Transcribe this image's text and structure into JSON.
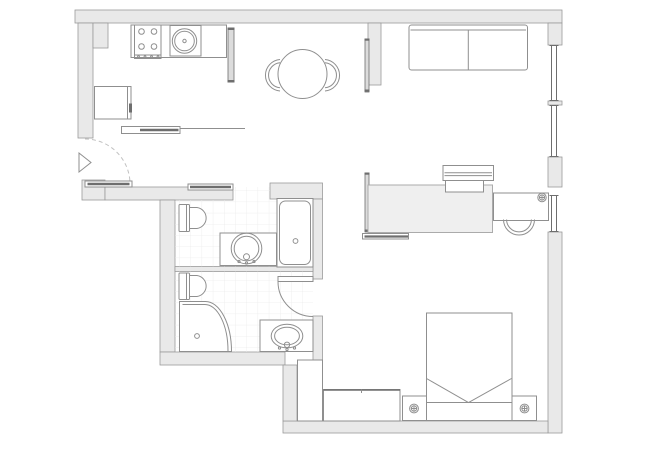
{
  "meta": {
    "kind": "floor-plan",
    "description": "apartment floor plan drawing, no text labels"
  },
  "colors": {
    "paper": "#ffffff",
    "wall_fill": "#e9e9e9",
    "wall_stroke": "#9a9a9a",
    "furniture_stroke": "#8f8f8f",
    "dark_detail": "#6e6e6e",
    "panel_fill": "#dcdcdc",
    "tile_line": "#ececec",
    "daybed_fill": "#efefef",
    "dash_line": "#c2c2c2"
  },
  "legend": {
    "windows_on_right_wall": 3,
    "rooms": [
      {
        "name": "entry",
        "items": [
          "entrance-triangle-marker",
          "entry-door-swing",
          "entry-door-leaf"
        ]
      },
      {
        "name": "kitchen",
        "items": [
          "counter",
          "cooktop-4-burner",
          "round-sink",
          "refrigerator",
          "console-shelf",
          "sliding-panel"
        ]
      },
      {
        "name": "dining-area",
        "items": [
          "round-table",
          "chair-left",
          "chair-right"
        ]
      },
      {
        "name": "living-area",
        "items": [
          "two-seat-sofa",
          "partition-wall"
        ]
      },
      {
        "name": "study-sleep-area",
        "items": [
          "daybed",
          "bench",
          "low-console",
          "desk",
          "desk-lamp",
          "office-chair",
          "sliding-panel-upper",
          "sliding-panel-lower"
        ]
      },
      {
        "name": "bathroom-1",
        "items": [
          "sliding-door",
          "toilet",
          "vanity-round-sink",
          "bathtub",
          "tiled-floor"
        ]
      },
      {
        "name": "bathroom-2",
        "items": [
          "hinged-door",
          "toilet",
          "corner-shower",
          "vanity-oval-sink",
          "tiled-floor"
        ]
      },
      {
        "name": "bedroom",
        "items": [
          "double-bed",
          "nightstand-left",
          "nightstand-right",
          "table-lamp-left",
          "table-lamp-right",
          "dresser",
          "closet"
        ]
      }
    ]
  }
}
